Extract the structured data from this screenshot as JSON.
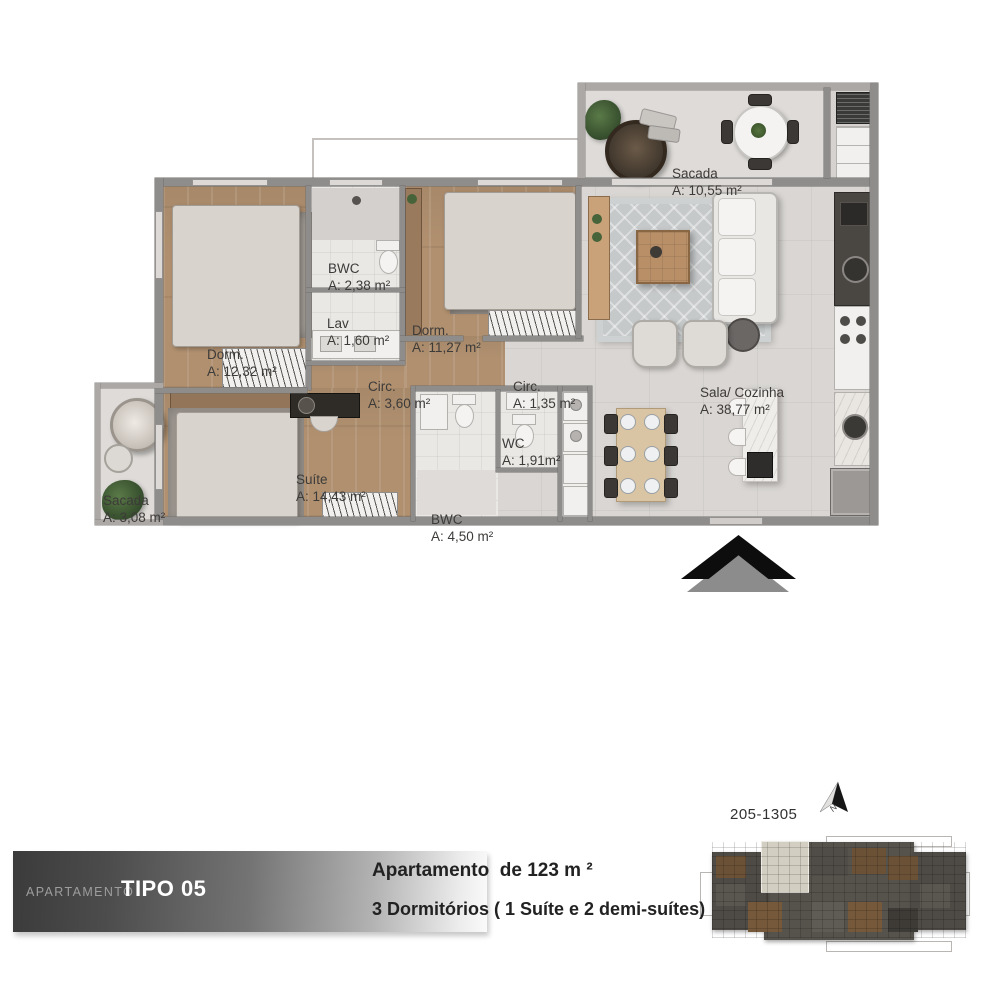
{
  "plan": {
    "rooms": [
      {
        "name": "Sacada",
        "area": "A: 10,55 m²"
      },
      {
        "name": "BWC",
        "area": "A: 2,38 m²"
      },
      {
        "name": "Lav",
        "area": "A: 1,60 m²"
      },
      {
        "name": "Dorm.",
        "area": "A: 12,32 m²"
      },
      {
        "name": "Dorm.",
        "area": "A: 11,27 m²"
      },
      {
        "name": "Circ.",
        "area": "A: 3,60 m²"
      },
      {
        "name": "Circ.",
        "area": "A: 1,35 m²"
      },
      {
        "name": "Sala/ Cozinha",
        "area": "A: 38,77 m²"
      },
      {
        "name": "Sacada",
        "area": "A: 3,08 m²"
      },
      {
        "name": "Suíte",
        "area": "A: 14,43 m²"
      },
      {
        "name": "WC",
        "area": "A: 1,91m²"
      },
      {
        "name": "BWC",
        "area": "A: 4,50 m²"
      }
    ]
  },
  "footer": {
    "label_small": "APARTAMENTO",
    "label_big": "TIPO 05",
    "line1": "Apartamento  de 123 m ²",
    "line2": "3 Dormitórios ( 1 Suíte e 2 demi-suítes)"
  },
  "keyplan": {
    "units": "205-1305",
    "north": "N"
  },
  "colors": {
    "wood": "#b0906f",
    "tile": "#d9d6d3",
    "wall": "#8f8d8b",
    "banner_dark": "#3b3b3b",
    "arrow_black": "#0d0d0d",
    "arrow_gray": "#8c8c8c"
  }
}
